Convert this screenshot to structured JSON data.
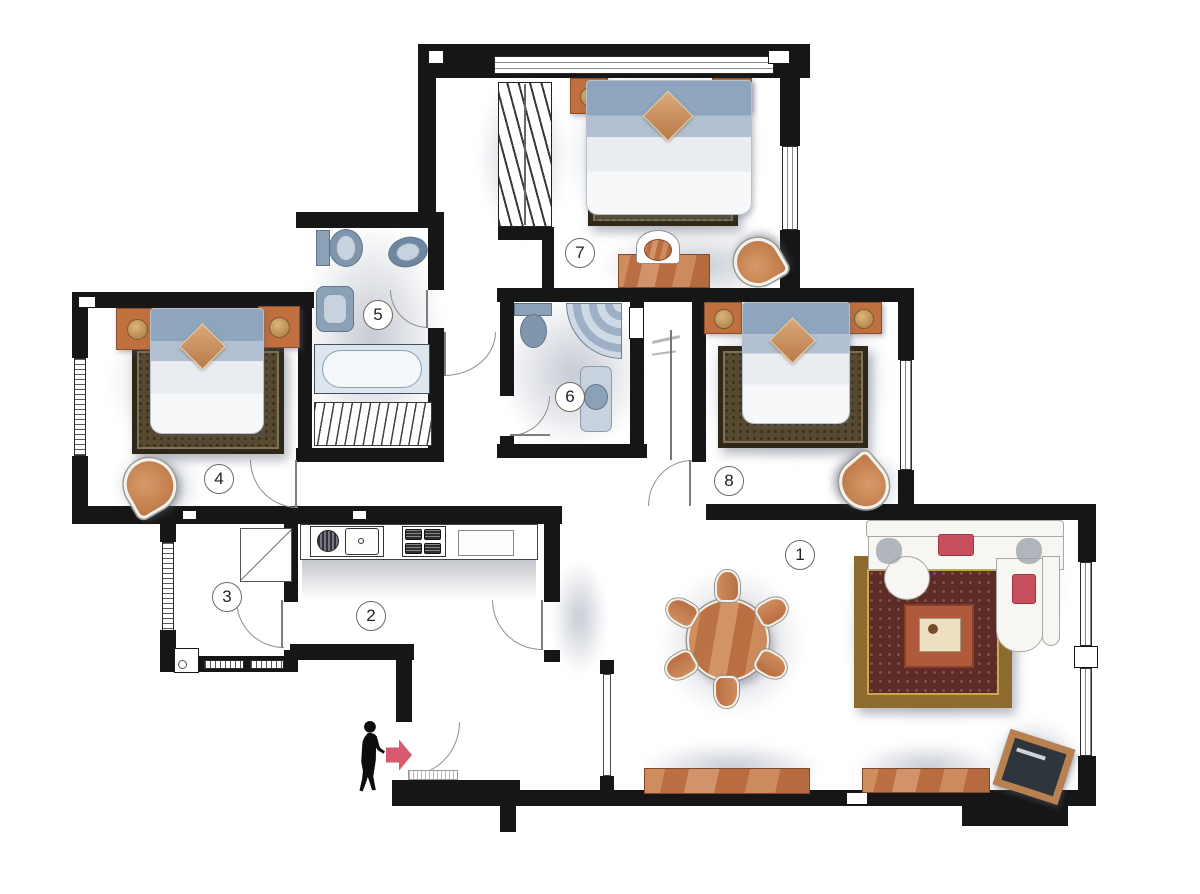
{
  "plan": {
    "type": "apartment-floor-plan",
    "style": "watercolor architectural rendering",
    "rooms": [
      {
        "number": "1",
        "name": "living-dining-room",
        "furniture": [
          "round-dining-table",
          "six-dining-chairs",
          "l-shaped-sofa",
          "coffee-table",
          "ornate-area-rug",
          "sideboard",
          "sideboard",
          "tv-cabinet",
          "glass-screen-partition"
        ]
      },
      {
        "number": "2",
        "name": "kitchen",
        "furniture": [
          "kitchen-counter",
          "sink",
          "gas-cooktop",
          "worktop"
        ]
      },
      {
        "number": "3",
        "name": "utility-room",
        "furniture": [
          "cabinet",
          "corner-fixture"
        ]
      },
      {
        "number": "4",
        "name": "bedroom-left",
        "furniture": [
          "double-bed",
          "nightstand-with-lamp",
          "nightstand-with-lamp",
          "bedside-rug",
          "round-armchair"
        ]
      },
      {
        "number": "5",
        "name": "bathroom-main",
        "furniture": [
          "toilet",
          "washbasin",
          "vanity-sink",
          "bathtub",
          "storage-shelf"
        ]
      },
      {
        "number": "6",
        "name": "bathroom-second",
        "furniture": [
          "toilet",
          "corner-shower",
          "washbasin",
          "wall-niche"
        ]
      },
      {
        "number": "7",
        "name": "bedroom-top",
        "furniture": [
          "double-bed",
          "nightstand-with-lamp",
          "nightstand-with-lamp",
          "bedside-rug",
          "wardrobe-with-hangers",
          "desk",
          "desk-chair",
          "round-armchair"
        ]
      },
      {
        "number": "8",
        "name": "bedroom-right",
        "furniture": [
          "double-bed",
          "nightstand-with-lamp",
          "nightstand-with-lamp",
          "bedside-rug",
          "round-armchair"
        ]
      }
    ],
    "entrance": {
      "person": "person-silhouette",
      "arrow": "red-entry-arrow",
      "arrow_direction": "right"
    },
    "colors": {
      "wall": "#161616",
      "wood": "#c07a4c",
      "bed_blue": "#93a9c0",
      "rug_dark": "#57492f",
      "rug_border_gold": "#8d6b2f",
      "rug_field_red": "#5d2b28",
      "accent_red": "#d85a6e",
      "fixture_blue": "#8ba1b8",
      "sofa_white": "#f6f5f2"
    }
  }
}
